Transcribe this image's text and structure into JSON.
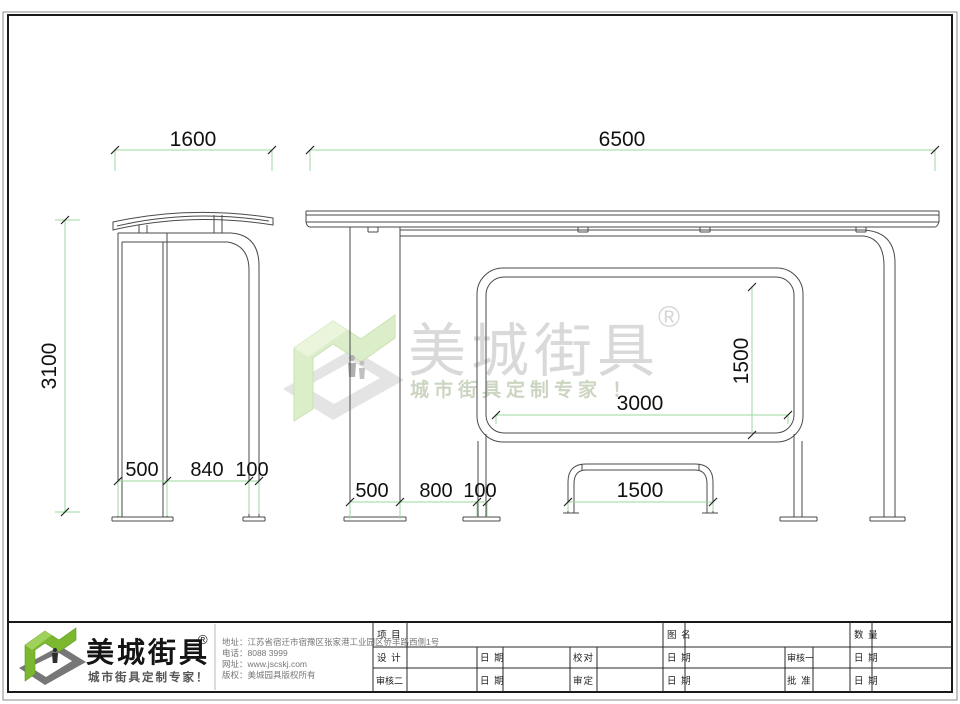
{
  "side_view": {
    "width_dim": "1600",
    "height_dim": "3100",
    "base_dims": [
      "500",
      "840",
      "100"
    ]
  },
  "front_view": {
    "width_dim": "6500",
    "panel_width_dim": "3000",
    "panel_height_dim": "1500",
    "base_dims": [
      "500",
      "800",
      "100"
    ],
    "bench_dim": "1500"
  },
  "watermark": {
    "brand": "美城街具",
    "registered": "®",
    "slogan": "城市街具定制专家 ！"
  },
  "title_block": {
    "brand": "美城街具",
    "registered": "®",
    "slogan": "城市街具定制专家！",
    "address": "地址：江苏省宿迁市宿豫区张家港工业园区侨丰路西侧1号",
    "phone": "电话：8088 3999",
    "website": "网址：www.jscskj.com",
    "copyright": "版权：美城园具版权所有",
    "table": {
      "project": "项 目",
      "drawing_name": "图 名",
      "quantity": "数 量",
      "design": "设 计",
      "date": "日 期",
      "proofread": "校对",
      "reviewer1": "审核一",
      "reviewer2": "审核二",
      "verify": "审定",
      "approve": "批 准"
    }
  },
  "colors": {
    "dimension_line": "#9bd89b",
    "drawing_line": "#4a4a4a",
    "logo_green": "#7cb82f",
    "watermark_text": "#d9d9d9"
  }
}
